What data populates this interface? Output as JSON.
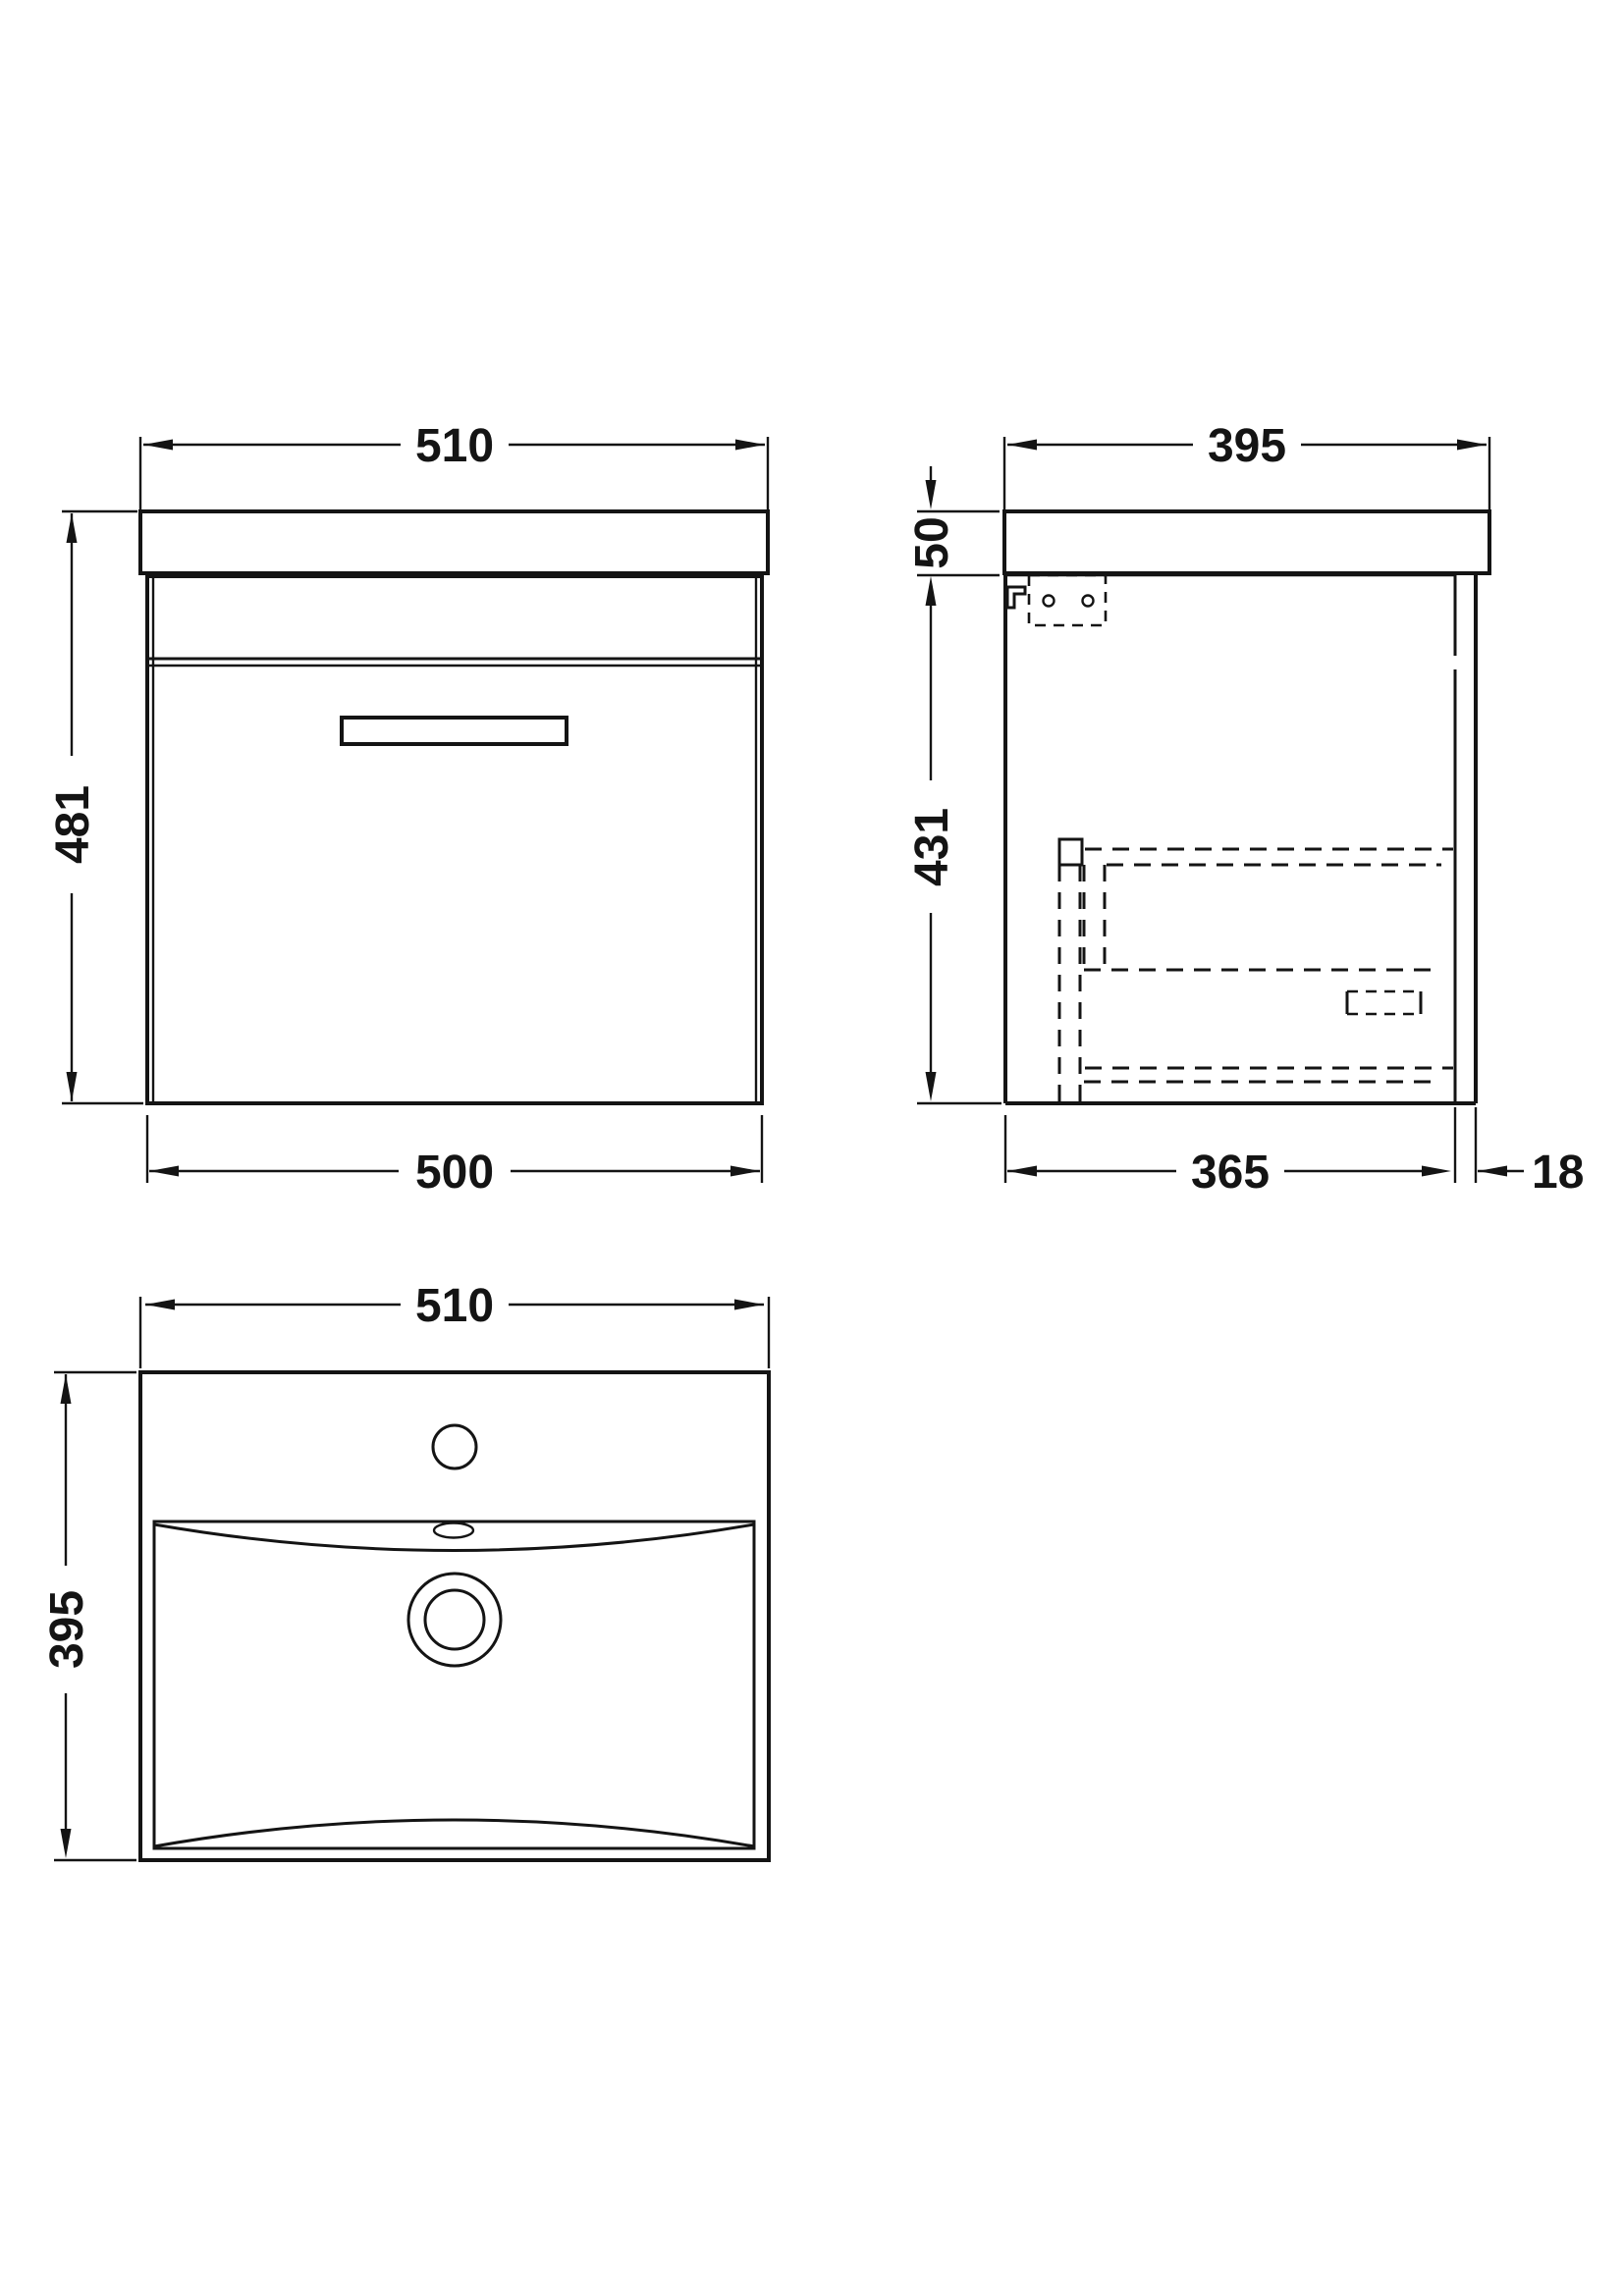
{
  "colors": {
    "line": "#141414",
    "background": "#ffffff"
  },
  "front_view": {
    "label": "front-elevation",
    "width_top": "510",
    "height_left": "481",
    "width_bottom": "500"
  },
  "side_view": {
    "label": "side-elevation",
    "depth_top": "395",
    "worktop_thickness": "50",
    "cabinet_height": "431",
    "cabinet_depth": "365",
    "back_rail": "18"
  },
  "plan_view": {
    "label": "basin-plan",
    "width_top": "510",
    "depth_left": "395"
  }
}
